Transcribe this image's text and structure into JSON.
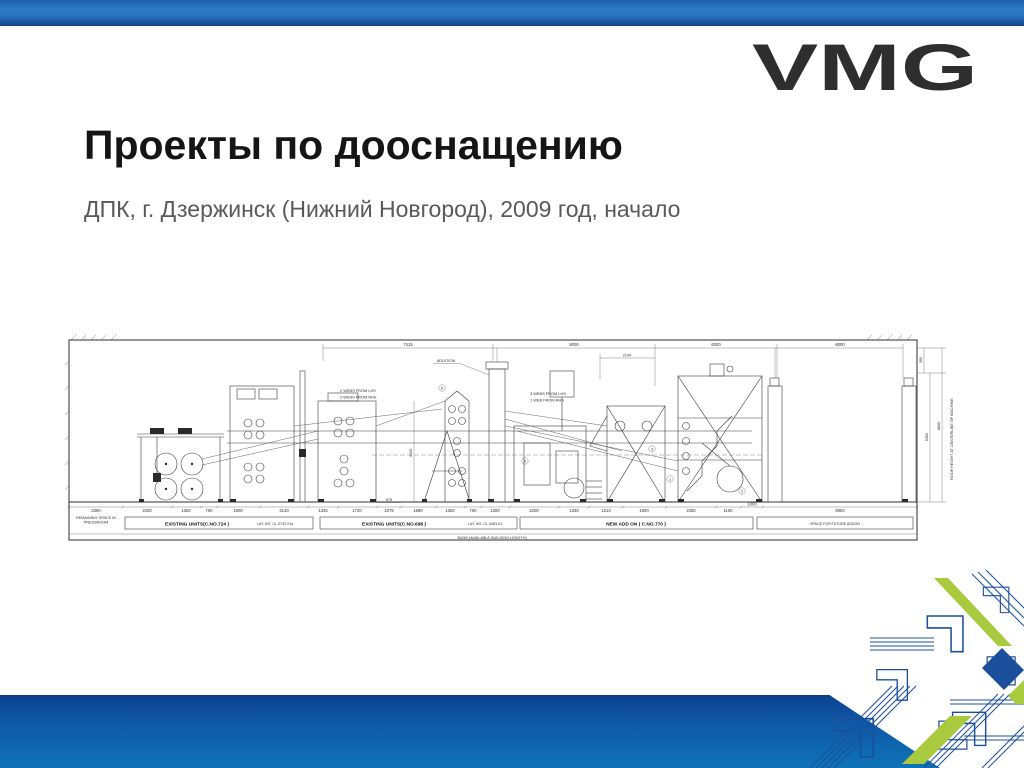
{
  "slide": {
    "title": "Проекты по дооснащению",
    "subtitle": "ДПК, г. Дзержинск (Нижний Новгород), 2009 год, начало",
    "logo_text": "VMG"
  },
  "colors": {
    "accent_blue": "#1c4f9b",
    "accent_green": "#a9c93f",
    "band_top": "#0d4493",
    "band_bottom": "#0f73b6",
    "logo_gradient_top": "#16407f",
    "logo_gradient_bottom": "#3fa3e3",
    "title_color": "#151515",
    "subtitle_color": "#595959"
  },
  "drawing": {
    "top_dimensions": [
      "7415",
      "8000",
      "6000",
      "6000"
    ],
    "top_sub_dimension": "2194",
    "bottom_dimensions": [
      "2390",
      "2200",
      "1300",
      "700",
      "1900",
      "2140",
      "1345",
      "1720",
      "1075",
      "1580",
      "1300",
      "700",
      "1300",
      "2200",
      "1345",
      "1513",
      "1900",
      "2250",
      "1100",
      "1000",
      "6900"
    ],
    "annotations": {
      "addition": "ADDITION",
      "webs_left_1": "2 WEBS FROM LHS",
      "webs_left_2": "2 WEBS FROM RHS",
      "webs_right_1": "3 WEBS FROM LHS",
      "webs_right_2": "1 WEB FROM RHS",
      "remaining_space_1": "REMAINING SPACE IN",
      "remaining_space_2": "PRESSROOM",
      "vertical_dim": "4405",
      "sub_dim_675": "675",
      "right_dim_300": "300",
      "right_dim_5350": "5350",
      "right_dim_8800": "8800",
      "roof_height_label": "ROOF HEIGHT AT CENTERLINE OF MACHINE",
      "total_length": "36260 (AVAILABLE BUILDING LENGTH)"
    },
    "section_labels": [
      {
        "bold": "EXISTING UNITS(C.NO.724 )",
        "small": "LAY. NO. CL-0742.01a"
      },
      {
        "bold": "EXISTING UNITS(C.NO.698 )",
        "small": "LAY. NO. CL-0483.01"
      },
      {
        "bold": "NEW ADD ON ( C.NO.770 )",
        "small": ""
      },
      {
        "bold": "",
        "small": "SPACE FOR FUTURE ADDON"
      }
    ],
    "ref_numbers": [
      "1",
      "2",
      "3",
      "5",
      "6"
    ]
  }
}
